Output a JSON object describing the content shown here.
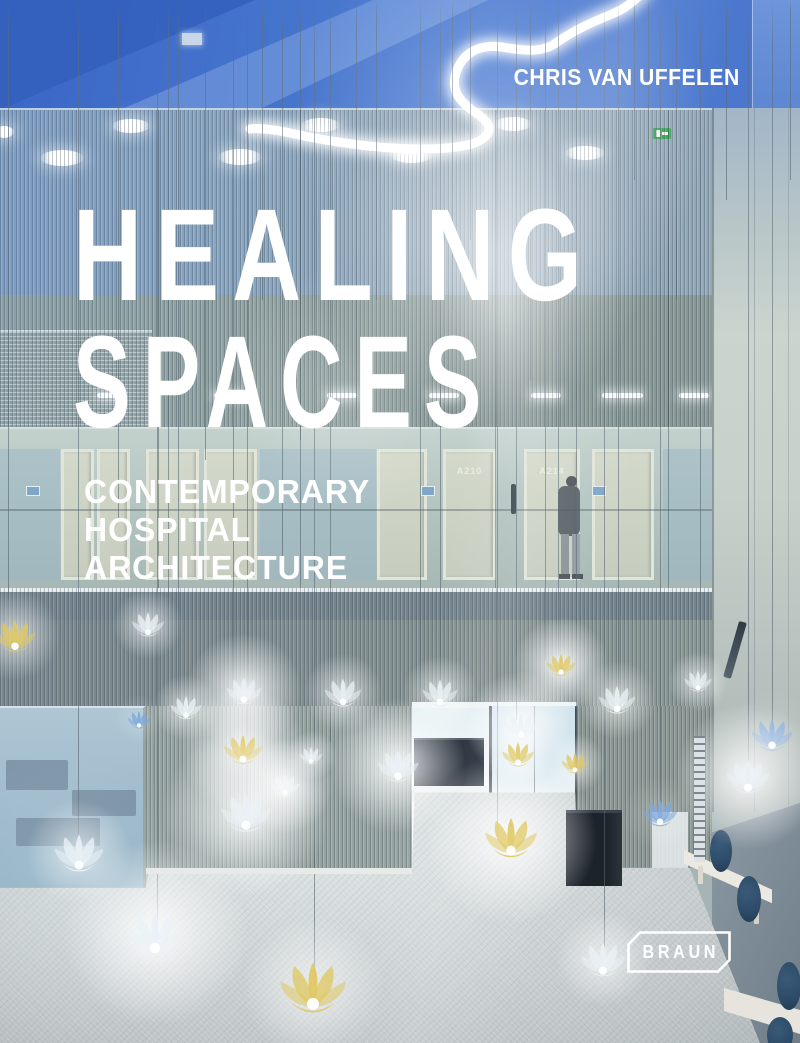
{
  "cover": {
    "author": "CHRIS VAN UFFELEN",
    "title_line1": "HEALING",
    "title_line2": "SPACES",
    "subtitle_line1": "CONTEMPORARY",
    "subtitle_line2": "HOSPITAL",
    "subtitle_line3": "ARCHITECTURE",
    "publisher": "BRAUN"
  },
  "palette": {
    "ceiling_blue": "#4574cd",
    "ceiling_blue_dark": "#3460bd",
    "slat_wall_blue": "#8aa5bf",
    "slat_wall_green": "#93a3a0",
    "corridor_wall": "#b7c7c3",
    "right_wall_light": "#c7d1cb",
    "right_wall_dark": "#7c8c99",
    "floor_gray": "#ced4d5",
    "bench_white": "#ece9e2",
    "cushion_navy": "#2d4b68",
    "lamp_white": "#e9f1f6",
    "lamp_yellow": "#dfc75e",
    "lamp_blue": "#7ea8dc",
    "neon_white": "#ffffff",
    "exit_green": "#2fa14b",
    "text_white": "#ffffff"
  },
  "scene": {
    "wires": [
      [
        8,
        600
      ],
      [
        78,
        848
      ],
      [
        118,
        520
      ],
      [
        157,
        928
      ],
      [
        168,
        640
      ],
      [
        178,
        700
      ],
      [
        205,
        460
      ],
      [
        233,
        688
      ],
      [
        247,
        806
      ],
      [
        262,
        300
      ],
      [
        282,
        560
      ],
      [
        300,
        440
      ],
      [
        314,
        986
      ],
      [
        330,
        742
      ],
      [
        356,
        420
      ],
      [
        376,
        300
      ],
      [
        420,
        688
      ],
      [
        440,
        686
      ],
      [
        452,
        310
      ],
      [
        470,
        240
      ],
      [
        497,
        836
      ],
      [
        516,
        720
      ],
      [
        530,
        380
      ],
      [
        545,
        660
      ],
      [
        558,
        656
      ],
      [
        576,
        756
      ],
      [
        604,
        952
      ],
      [
        618,
        694
      ],
      [
        634,
        180
      ],
      [
        648,
        160
      ],
      [
        660,
        806
      ],
      [
        676,
        300
      ],
      [
        700,
        672
      ],
      [
        726,
        200
      ],
      [
        748,
        772
      ],
      [
        772,
        730
      ],
      [
        790,
        180
      ]
    ],
    "ceiling_downlights": [
      [
        62,
        156,
        22,
        8
      ],
      [
        131,
        124,
        19,
        7
      ],
      [
        240,
        155,
        22,
        8
      ],
      [
        321,
        123,
        19,
        7
      ],
      [
        411,
        153,
        21,
        8
      ],
      [
        513,
        122,
        19,
        7
      ],
      [
        585,
        151,
        20,
        7
      ],
      [
        4,
        130,
        10,
        6
      ]
    ],
    "corridor_ceiling_lights": [
      [
        97,
        25
      ],
      [
        214,
        31
      ],
      [
        327,
        30
      ],
      [
        429,
        30
      ],
      [
        531,
        30
      ],
      [
        602,
        41
      ],
      [
        679,
        30
      ]
    ],
    "doors": [
      {
        "x": 61,
        "w": 33,
        "label": ""
      },
      {
        "x": 97,
        "w": 33,
        "label": ""
      },
      {
        "x": 146,
        "w": 53,
        "label": ""
      },
      {
        "x": 204,
        "w": 53,
        "label": ""
      },
      {
        "x": 377,
        "w": 50,
        "label": ""
      },
      {
        "x": 443,
        "w": 53,
        "label": "A210"
      },
      {
        "x": 524,
        "w": 56,
        "label": "A214"
      },
      {
        "x": 592,
        "w": 62,
        "label": ""
      }
    ],
    "door_plates": [
      [
        26,
        484
      ],
      [
        421,
        484
      ],
      [
        592,
        484
      ]
    ],
    "pendant_lamps": [
      [
        15,
        647,
        54,
        "yellow",
        1
      ],
      [
        148,
        633,
        42,
        "white",
        1
      ],
      [
        186,
        716,
        40,
        "white",
        1
      ],
      [
        244,
        701,
        46,
        "white",
        2
      ],
      [
        139,
        726,
        30,
        "blue",
        0
      ],
      [
        343,
        703,
        48,
        "white",
        1
      ],
      [
        440,
        703,
        46,
        "white",
        1
      ],
      [
        243,
        760,
        50,
        "yellow",
        2
      ],
      [
        311,
        762,
        30,
        "white",
        1
      ],
      [
        398,
        777,
        54,
        "white",
        2
      ],
      [
        285,
        794,
        38,
        "white",
        2
      ],
      [
        521,
        735,
        44,
        "white",
        2
      ],
      [
        518,
        763,
        42,
        "yellow",
        1
      ],
      [
        575,
        771,
        36,
        "yellow",
        1
      ],
      [
        561,
        673,
        38,
        "yellow",
        2
      ],
      [
        617,
        710,
        48,
        "white",
        1
      ],
      [
        698,
        689,
        36,
        "white",
        1
      ],
      [
        772,
        746,
        54,
        "blue",
        0
      ],
      [
        748,
        789,
        58,
        "white",
        2
      ],
      [
        660,
        823,
        46,
        "blue",
        0
      ],
      [
        246,
        827,
        66,
        "white",
        2
      ],
      [
        79,
        866,
        64,
        "white",
        1
      ],
      [
        155,
        949,
        74,
        "white",
        2
      ],
      [
        313,
        1006,
        86,
        "yellow",
        1
      ],
      [
        511,
        852,
        68,
        "yellow",
        2
      ],
      [
        603,
        972,
        58,
        "white",
        1
      ]
    ],
    "seat_cushions": [
      [
        721,
        851,
        11,
        21
      ],
      [
        749,
        899,
        12,
        23
      ],
      [
        789,
        986,
        12,
        24
      ],
      [
        780,
        1035,
        13,
        18
      ]
    ]
  }
}
